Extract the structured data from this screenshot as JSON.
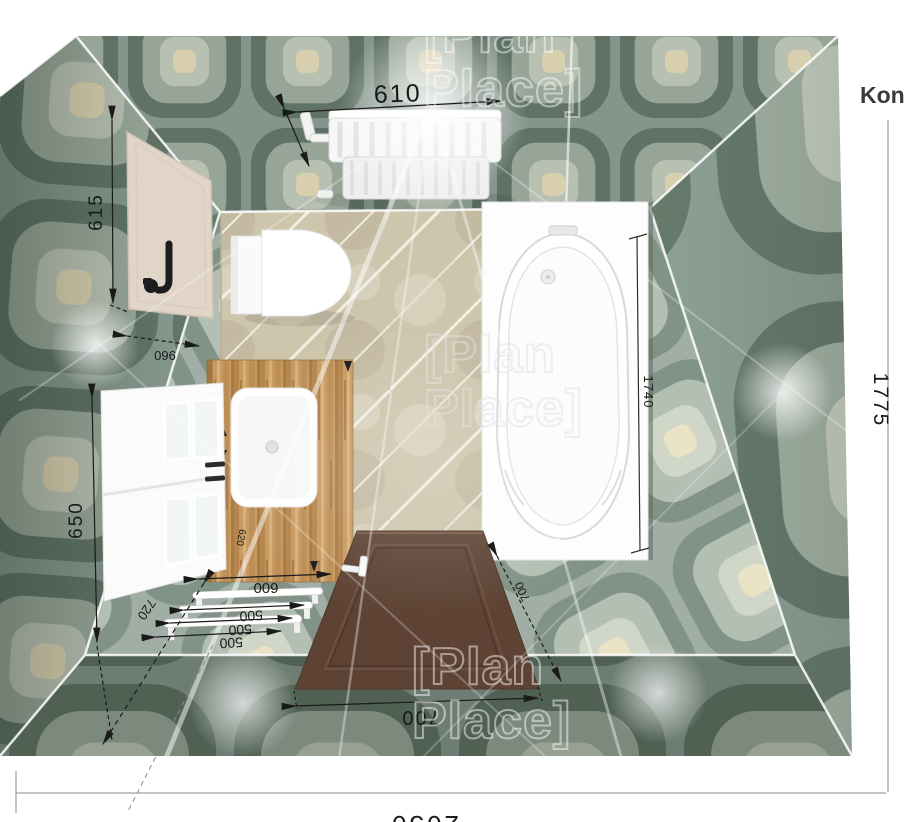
{
  "viewport": {
    "corner_note": "Kons"
  },
  "watermark": {
    "line1": "[Plan",
    "line2": "Place]"
  },
  "dimensions": {
    "radiator_width": "610",
    "panel_height": "615",
    "panel_width": "960",
    "cabinet_height": "650",
    "cabinet_offset": "720",
    "vanity_width": "600",
    "vanity_depth": "620",
    "rail1": "500",
    "rail2": "500",
    "rail3": "500",
    "bathtub_length": "1740",
    "door_width": "700",
    "door_width_side": "700",
    "room_depth": "1775",
    "room_width": "2050"
  },
  "colors": {
    "wall_base": "#8ea196",
    "wall_dark": "#66796c",
    "wall_light": "#a9b8ab",
    "wall_pale": "#c6cfc0",
    "accent_cream": "#e9dfbd",
    "marble_floor": "#cdc5ac",
    "wood_counter": "#c79a62",
    "door_brown": "#5e4334",
    "fixture_white": "#fafafa",
    "dimension_ink": "#1a1a1a"
  }
}
